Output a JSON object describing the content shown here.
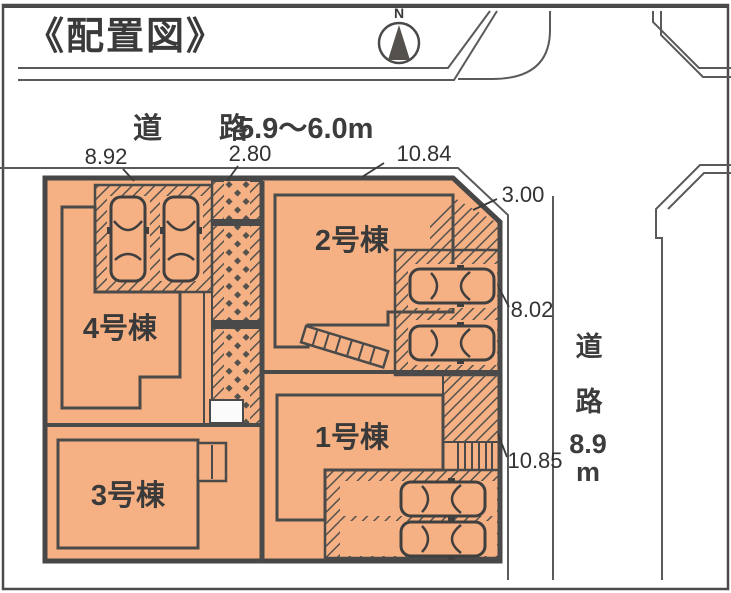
{
  "page": {
    "title": "《配置図》"
  },
  "compass": {
    "north_label": "N"
  },
  "roads": {
    "top": {
      "label": "道　路",
      "width": "5.9～6.0m"
    },
    "right": {
      "char1": "道",
      "char2": "路",
      "width": "8.9",
      "unit": "m"
    }
  },
  "dimensions": {
    "frontage_left": "8.92",
    "walkway_width": "2.80",
    "frontage_right": "10.84",
    "corner_chamfer": "3.00",
    "right_upper": "8.02",
    "right_lower": "10.85"
  },
  "buildings": {
    "b1": {
      "label": "1号棟"
    },
    "b2": {
      "label": "2号棟"
    },
    "b3": {
      "label": "3号棟"
    },
    "b4": {
      "label": "4号棟"
    }
  },
  "colors": {
    "lot_fill": "#f5b183",
    "outline": "#4a4a4a",
    "road_line": "#5a5a5a",
    "text": "#2f2f2f"
  }
}
